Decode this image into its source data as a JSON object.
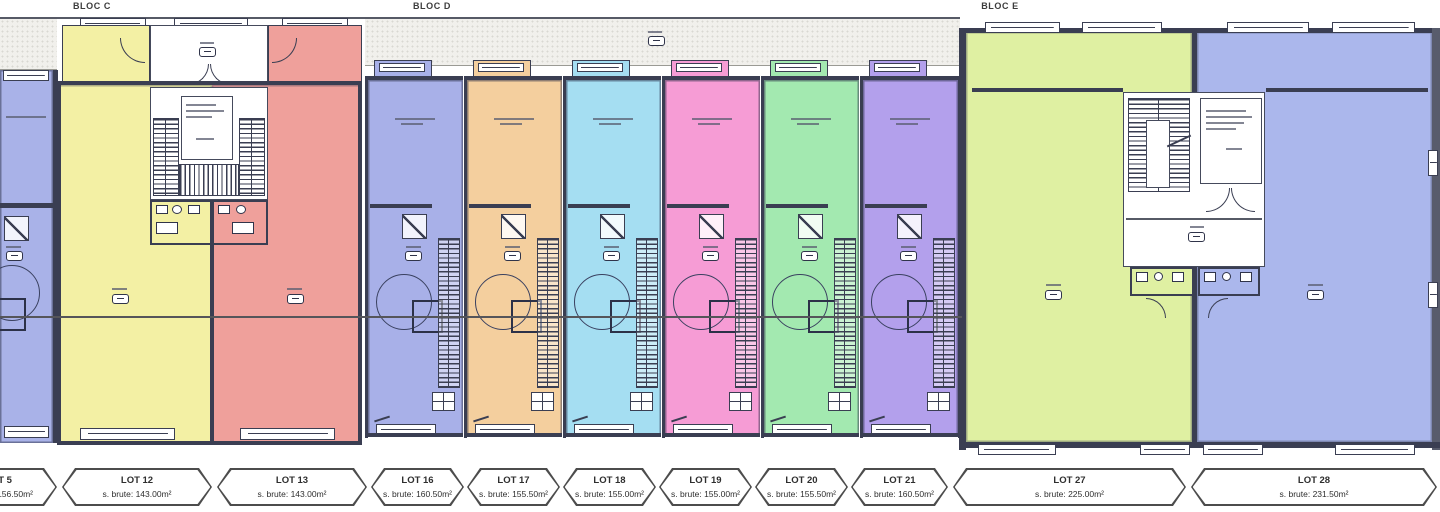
{
  "blocs": [
    {
      "label": "BLOC C"
    },
    {
      "label": "BLOC D"
    },
    {
      "label": "BLOC E"
    }
  ],
  "lots_band": [
    {
      "lot": "LOT 5",
      "area": "s. brute: 156.50m²"
    },
    {
      "lot": "LOT 12",
      "area": "s. brute: 143.00m²"
    },
    {
      "lot": "LOT 13",
      "area": "s. brute: 143.00m²"
    },
    {
      "lot": "LOT 16",
      "area": "s. brute: 160.50m²"
    },
    {
      "lot": "LOT 17",
      "area": "s. brute: 155.50m²"
    },
    {
      "lot": "LOT 18",
      "area": "s. brute: 155.00m²"
    },
    {
      "lot": "LOT 19",
      "area": "s. brute: 155.00m²"
    },
    {
      "lot": "LOT 20",
      "area": "s. brute: 155.50m²"
    },
    {
      "lot": "LOT 21",
      "area": "s. brute: 160.50m²"
    },
    {
      "lot": "LOT 27",
      "area": "s. brute: 225.00m²"
    },
    {
      "lot": "LOT 28",
      "area": "s. brute: 231.50m²"
    }
  ],
  "bloc_d_units": [
    {
      "lot": "LOT 16",
      "color_key": "lot16"
    },
    {
      "lot": "LOT 17",
      "color_key": "lot17"
    },
    {
      "lot": "LOT 18",
      "color_key": "lot18"
    },
    {
      "lot": "LOT 19",
      "color_key": "lot19"
    },
    {
      "lot": "LOT 20",
      "color_key": "lot20"
    },
    {
      "lot": "LOT 21",
      "color_key": "lot21"
    }
  ],
  "colors": {
    "wall": "#585c6c",
    "wallDark": "#3a3e52",
    "walkway": "#f1f0ec",
    "walkwayDot": "#d9d8d2",
    "lot5": "#a9b2e8",
    "lot12": "#f3f0a4",
    "lot13": "#efa09b",
    "lot16": "#a8b0e8",
    "lot17": "#f4cf9e",
    "lot18": "#a5def2",
    "lot19": "#f69cd5",
    "lot20": "#a3e9b0",
    "lot21": "#b3a0ec",
    "lot27": "#dff0a2",
    "lot28": "#abb7ec"
  }
}
